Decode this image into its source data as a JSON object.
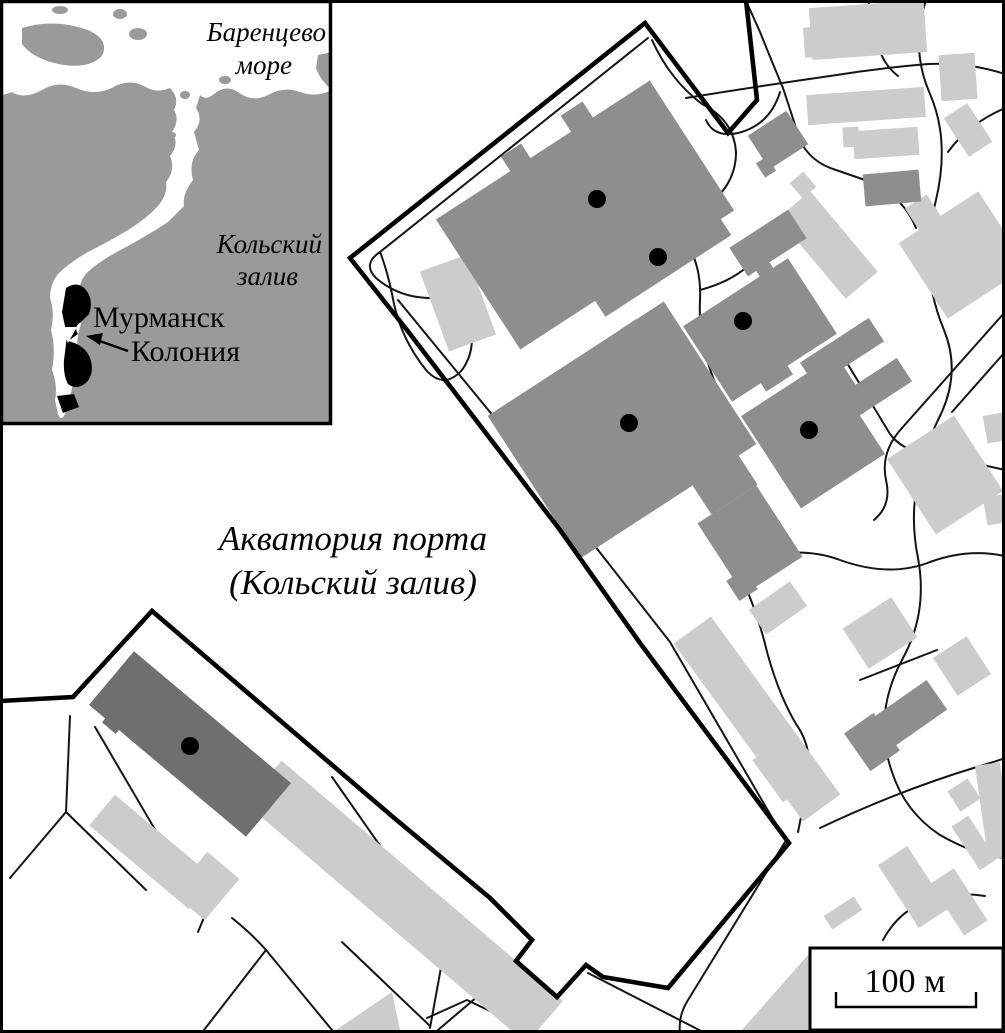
{
  "inset": {
    "sea_label": [
      "Баренцево",
      "море"
    ],
    "bay_label": [
      "Кольский",
      "залив"
    ],
    "city_label": "Мурманск",
    "colony_label": "Колония"
  },
  "main": {
    "water_label": [
      "Акватория порта",
      "(Кольский залив)"
    ],
    "scale_bar": {
      "label": "100 м"
    }
  },
  "colors": {
    "land": "#9a9a9a",
    "water": "#ffffff",
    "building_mid": "#8e8e8e",
    "building_dark": "#6f6f6f",
    "building_light": "#cccccc",
    "outline": "#000000"
  },
  "sample_points": {
    "count": 6,
    "radius": 9,
    "points": [
      {
        "x": 597,
        "y": 199
      },
      {
        "x": 658,
        "y": 257
      },
      {
        "x": 743,
        "y": 321
      },
      {
        "x": 629,
        "y": 423
      },
      {
        "x": 809,
        "y": 430
      },
      {
        "x": 190,
        "y": 746
      }
    ]
  }
}
